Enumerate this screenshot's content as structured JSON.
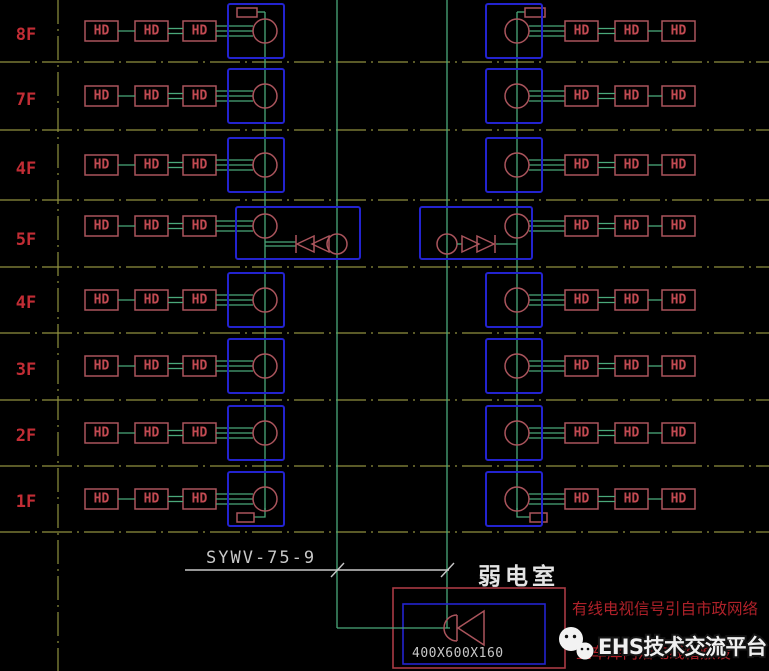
{
  "floors": [
    "8F",
    "7F",
    "4F",
    "5F",
    "4F",
    "3F",
    "2F",
    "1F"
  ],
  "hd_label": "HD",
  "bottom": {
    "cable_label": "SYWV-75-9",
    "room_label": "弱电室",
    "cabinet_size": "400X600X160",
    "note_line1": "有线电视信号引自市政网络",
    "note_line2": "至车库内沿电线槽敷设",
    "watermark": "EHS技术交流平台"
  },
  "colors": {
    "background": "#000000",
    "green_line": "#4aa87a",
    "olive_axis": "#90913f",
    "blue_box": "#2323cf",
    "red_device": "#aa545c",
    "red_text": "#c24a52",
    "red_floor": "#c22d35",
    "red_room": "#a93a44",
    "red_note": "#ae2129",
    "white_text": "#c8c8c8"
  }
}
